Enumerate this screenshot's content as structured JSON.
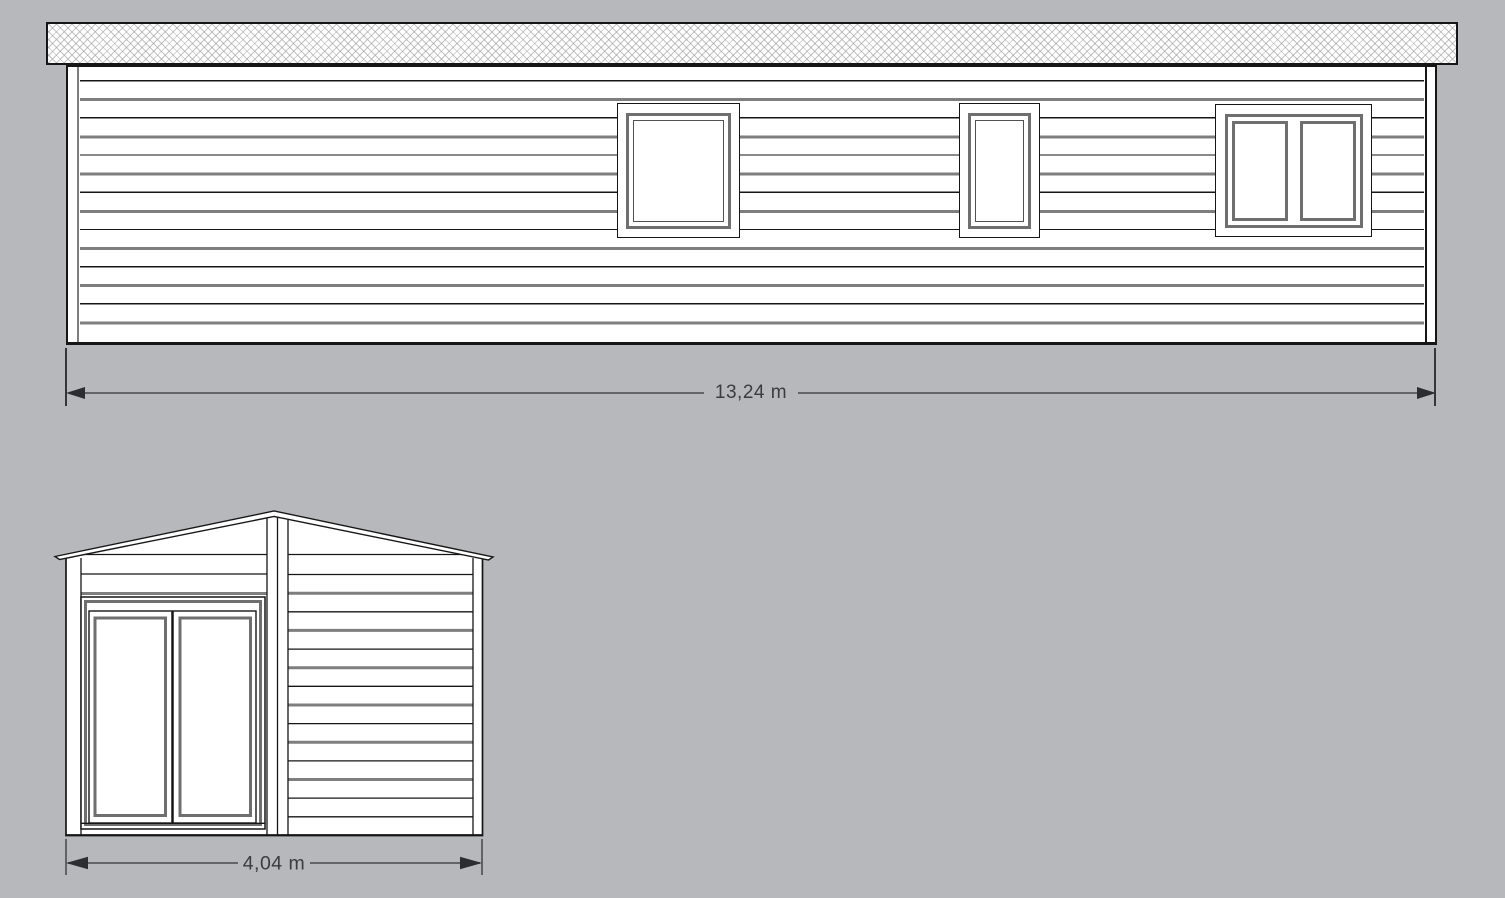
{
  "canvas": {
    "background": "#b7b8bb"
  },
  "colors": {
    "outline": "#161616",
    "siding_gray": "#7e7e7e",
    "window_frame_gray": "#6f6f6f",
    "dimension_line": "#63636a",
    "dimension_arrow": "#2c2c31",
    "dimension_text": "#3b3b42",
    "surface": "#ffffff"
  },
  "side_elevation": {
    "dimension": {
      "label": "13,24 m"
    },
    "roof": {
      "style": "hatched fascia band"
    },
    "windows": [
      {
        "position": "left",
        "sashes": 1
      },
      {
        "position": "center",
        "sashes": 1
      },
      {
        "position": "right",
        "sashes": 2
      }
    ]
  },
  "gable_elevation": {
    "dimension": {
      "label": "4,04 m"
    },
    "roof": {
      "style": "gable"
    },
    "door": {
      "leaves": 2
    }
  }
}
